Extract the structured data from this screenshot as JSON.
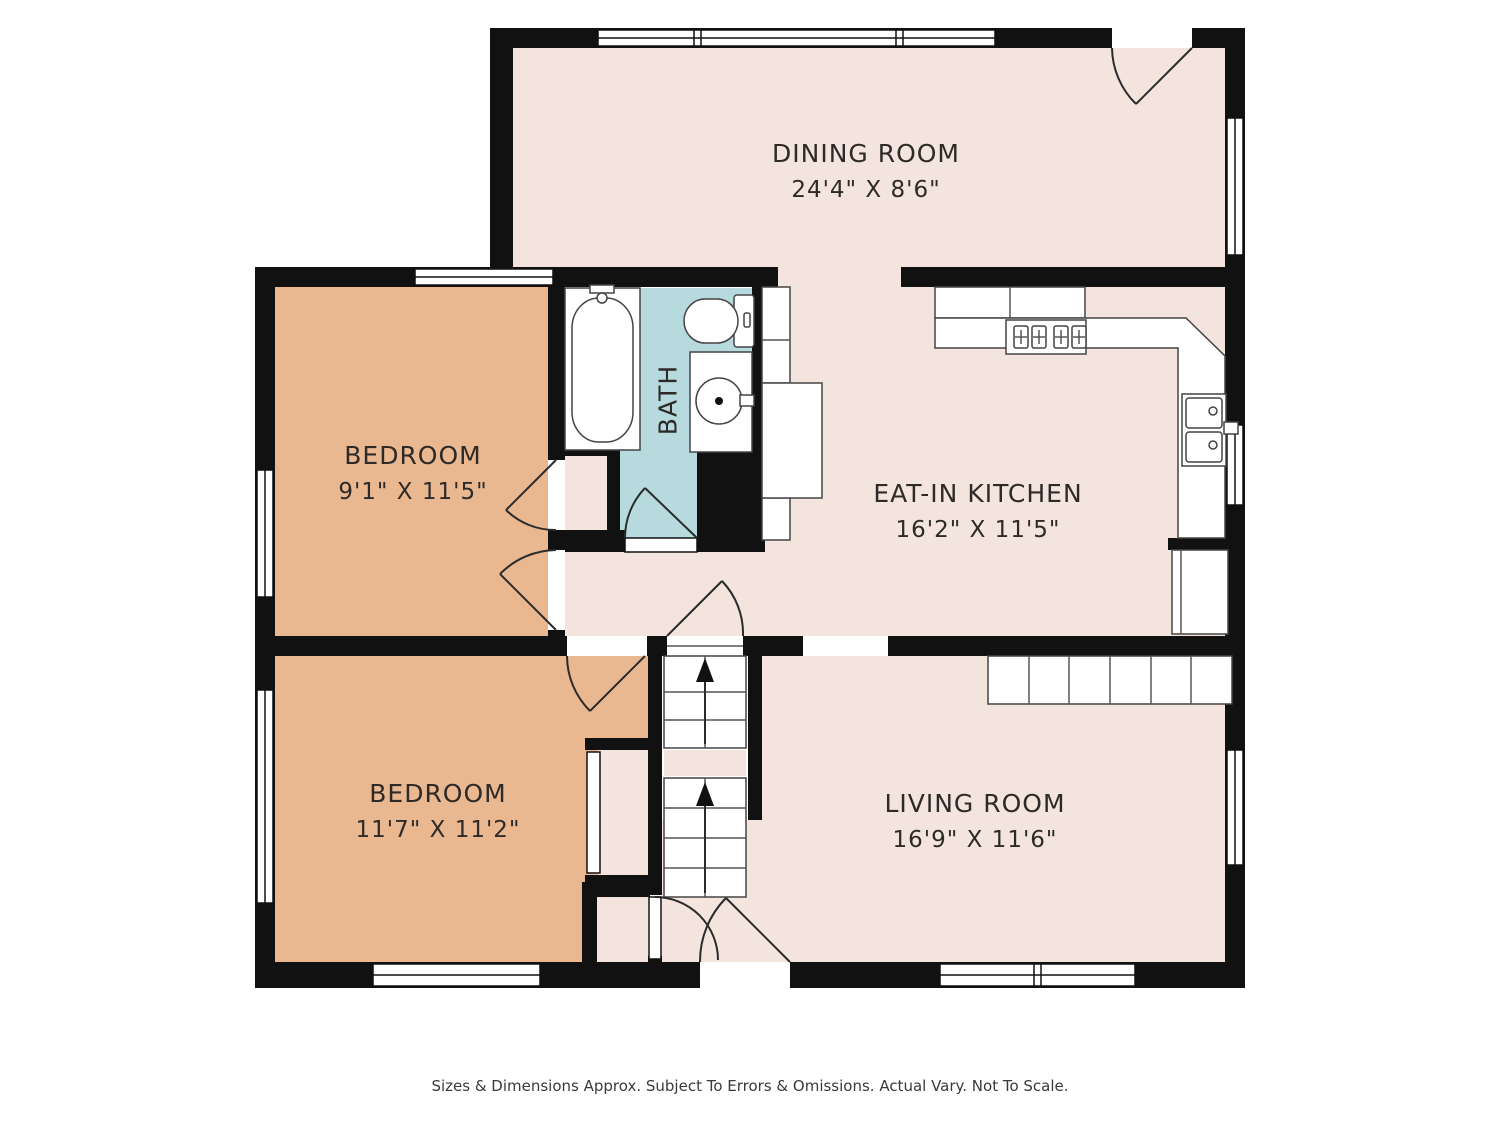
{
  "rooms": {
    "dining": {
      "name": "DINING ROOM",
      "dims": "24'4\" X 8'6\""
    },
    "bedroom_top": {
      "name": "BEDROOM",
      "dims": "9'1\" X 11'5\""
    },
    "bath": {
      "name": "BATH"
    },
    "kitchen": {
      "name": "EAT-IN KITCHEN",
      "dims": "16'2\" X 11'5\""
    },
    "bedroom_bottom": {
      "name": "BEDROOM",
      "dims": "11'7\" X 11'2\""
    },
    "living": {
      "name": "LIVING ROOM",
      "dims": "16'9\" X 11'6\""
    }
  },
  "footer": {
    "disclaimer": "Sizes & Dimensions Approx. Subject To Errors & Omissions. Actual Vary. Not To Scale."
  },
  "colors": {
    "wall": "#111111",
    "floor": "#f3e5de",
    "bedroom": "#eab890",
    "bath": "#b7dadf",
    "background": "#ffffff",
    "label_text": "#2e2a28",
    "footer_text": "#3a3a3a"
  }
}
